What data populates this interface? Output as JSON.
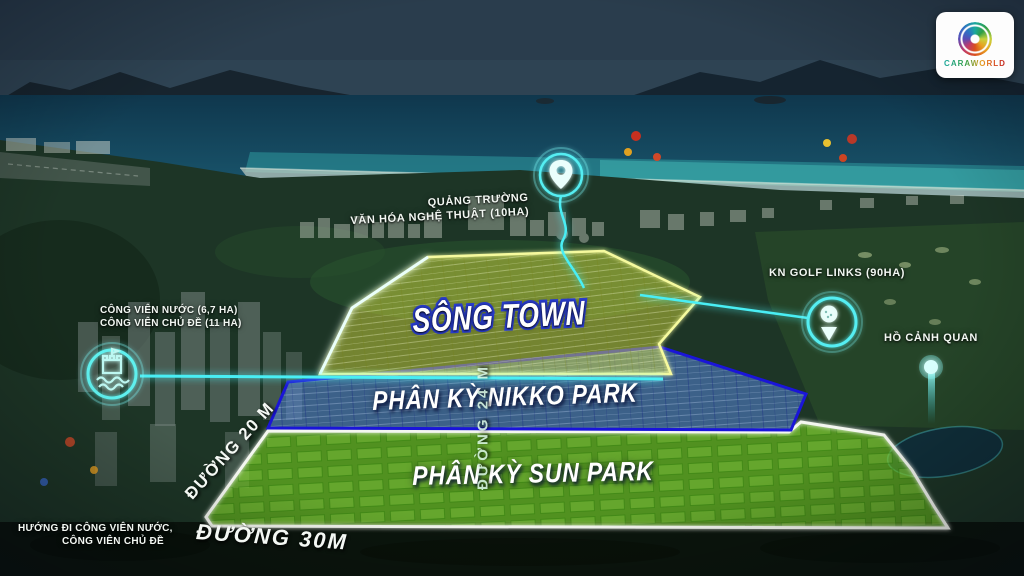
{
  "logo": {
    "name": "CARAWORLD"
  },
  "zones": {
    "song_town": {
      "label": "SÔNG TOWN"
    },
    "nikko_park": {
      "label": "PHÂN KỲ NIKKO PARK"
    },
    "sun_park": {
      "label": "PHÂN KỲ SUN PARK"
    }
  },
  "roads": {
    "road_20m": {
      "label": "ĐƯỜNG 20 M"
    },
    "road_24m": {
      "label": "ĐƯỜNG 24 M"
    },
    "road_30m": {
      "label": "ĐƯỜNG 30M"
    }
  },
  "landmarks": {
    "plaza": {
      "line1": "QUẢNG TRƯỜNG",
      "line2": "VĂN HÓA NGHỆ THUẬT (10HA)",
      "icon": "location-pin-icon"
    },
    "golf": {
      "label": "KN GOLF LINKS (90HA)",
      "icon": "golf-pin-icon"
    },
    "lake": {
      "label": "HỒ CẢNH QUAN",
      "icon": "glow-dot-icon"
    },
    "water_park": {
      "line1": "CÔNG VIÊN NƯỚC (6,7 HA)",
      "line2": "CÔNG VIÊN CHỦ ĐỀ (11 HA)",
      "icon": "water-park-icon"
    },
    "direction": {
      "line1": "HƯỚNG ĐI CÔNG VIÊN NƯỚC,",
      "line2": "CÔNG VIÊN CHỦ ĐỀ"
    }
  },
  "colors": {
    "accent_glow": "#49eef4",
    "song_town_fill": "#dde23f",
    "song_town_border": "#f6fa9e",
    "nikko_fill": "#5b8be5",
    "nikko_border": "#1a15d8",
    "sun_fill": "#77d41c",
    "sun_border": "#f4f7f0"
  }
}
